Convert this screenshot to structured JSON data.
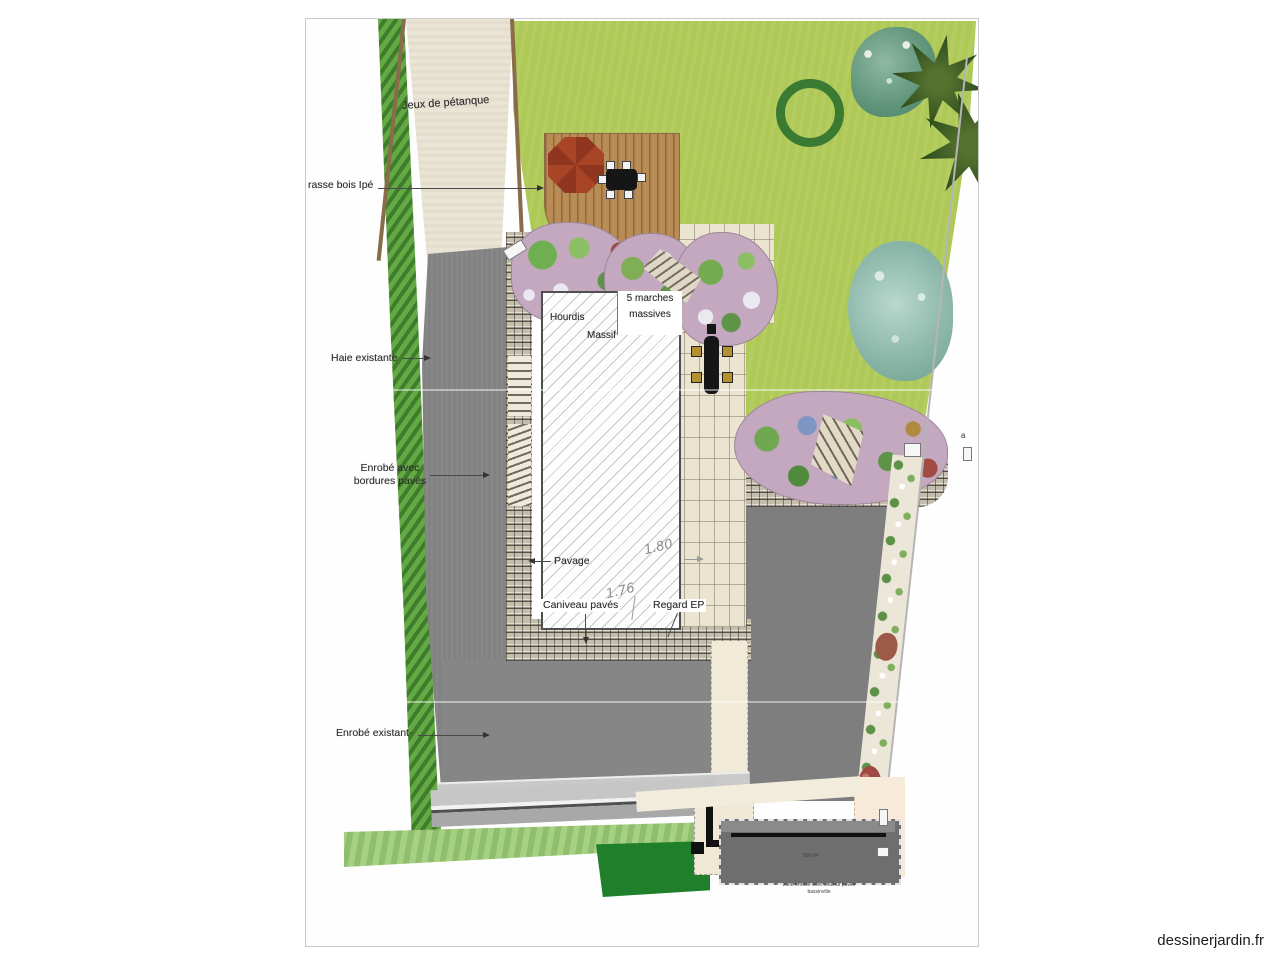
{
  "watermark": "dessinerjardin.fr",
  "palette": {
    "lawn_green": "#afc957",
    "hedge_green": "#4e9440",
    "asphalt_gray": "#828282",
    "deck_brown": "#b98c55",
    "flowerbed_mauve": "#c3a8bf",
    "paving_beige": "#ebe4d1",
    "new_hedge_green": "#1f7f2b"
  },
  "labels": {
    "petanque": "Jeux de pétanque",
    "terrasse": "rasse bois Ipé",
    "haie": "Haie existante",
    "enrobe_avec_1": "Enrobé avec",
    "enrobe_avec_2": "bordures pavés",
    "enrobe_existant": "Enrobé existant-",
    "hourdis": "Hourdis",
    "massif": "Massif",
    "marches_1": "5 marches",
    "marches_2": "massives",
    "pavage": "Pavage",
    "caniveau": "Caniveau pavés",
    "regard": "Regard EP",
    "dim180": "1.80",
    "dim176": "1.76",
    "mark_a": "a",
    "area_note": "560 m²",
    "note1": "zone enrobé avec couleur pavés",
    "note2": "bassinville"
  }
}
